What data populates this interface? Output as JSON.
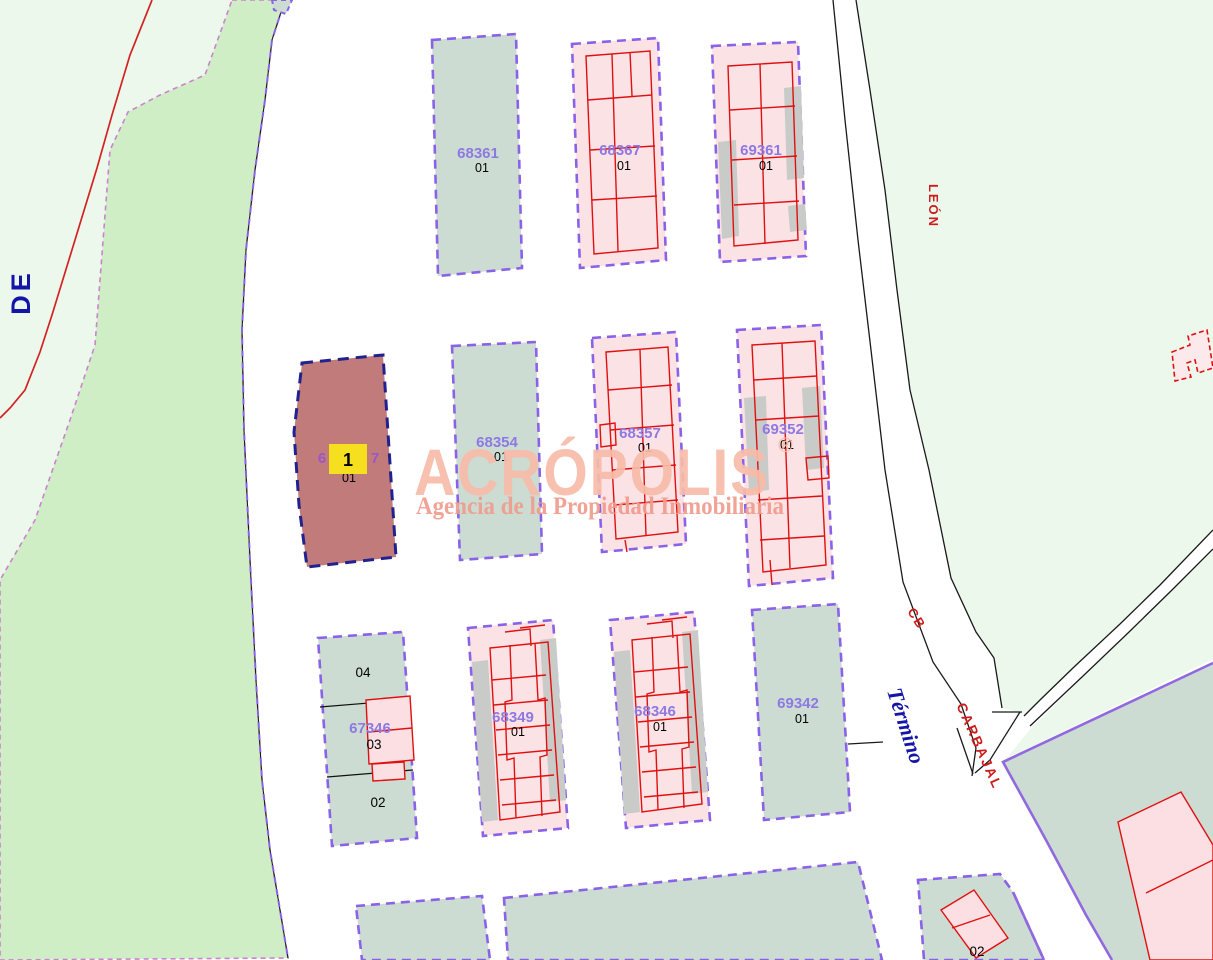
{
  "map_labels": {
    "de": "DE"
  },
  "streets": {
    "leon": "LEÓN",
    "cb": "CB",
    "carbajal": "CARBAJAL",
    "termino": "Término"
  },
  "watermark": {
    "brand": "ACRÓPOLIS",
    "registered_mark": "®",
    "tagline": "Agencia de la Propiedad Inmobiliaria"
  },
  "selected_parcel": {
    "ref_visible_left": "6",
    "ref_visible_right": "7",
    "sub": "01",
    "marker_label": "1"
  },
  "parcels": [
    {
      "ref": "68361",
      "sub": "01"
    },
    {
      "ref": "68367",
      "sub": "01"
    },
    {
      "ref": "69361",
      "sub": "01"
    },
    {
      "ref": "68354",
      "sub": "01"
    },
    {
      "ref": "68357",
      "sub": "01"
    },
    {
      "ref": "69352",
      "sub": "01"
    },
    {
      "ref": "67346",
      "subdivisions": [
        "04",
        "03",
        "02"
      ]
    },
    {
      "ref": "68349",
      "sub": "01"
    },
    {
      "ref": "68346",
      "sub": "01"
    },
    {
      "ref": "69342",
      "sub": "01"
    }
  ],
  "bottom_right_parcel": {
    "sub": "02"
  },
  "colors": {
    "parcel_boundary_purple": "#8a62e8",
    "green_parcel_fill": "#ccdcd3",
    "pink_parcel_fill": "#fbe2e5",
    "selected_parcel_fill": "#c27b7b",
    "selected_parcel_boundary": "#22228f",
    "building_line_red": "#e01010",
    "meadow_green": "#cfeec6",
    "pale_green": "#edf8ed",
    "street_label_red": "#cc1c1c",
    "street_label_blue": "#1414a8",
    "marker_yellow": "#f6df1e",
    "watermark_salmon": "#f8bca9"
  }
}
